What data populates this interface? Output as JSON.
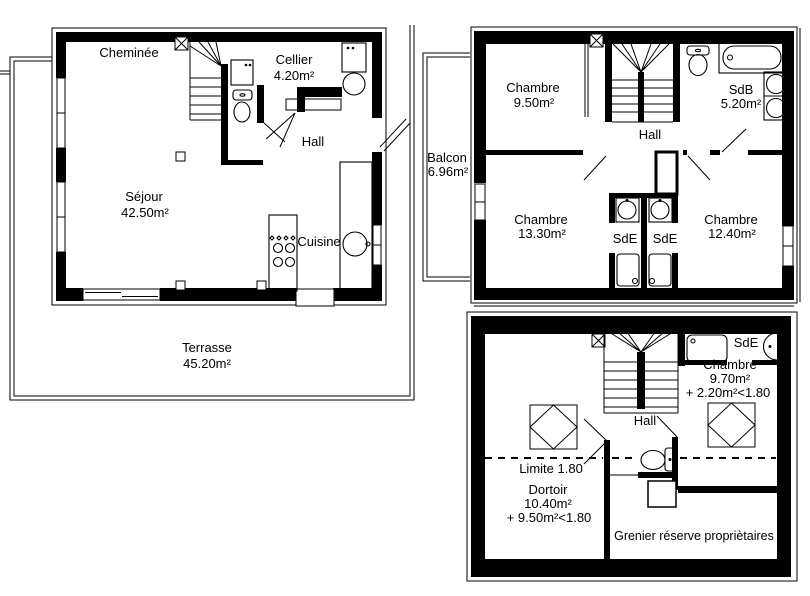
{
  "canvas": {
    "width": 810,
    "height": 596,
    "background": "#ffffff",
    "ink": "#000000"
  },
  "ground_floor": {
    "cheminee": "Cheminée",
    "cellier": "Cellier",
    "cellier_area": "4.20m²",
    "hall": "Hall",
    "sejour": "Séjour",
    "sejour_area": "42.50m²",
    "cuisine": "Cuisine",
    "terrasse": "Terrasse",
    "terrasse_area": "45.20m²"
  },
  "first_floor": {
    "chambre_nw": "Chambre",
    "chambre_nw_area": "9.50m²",
    "sdb": "SdB",
    "sdb_area": "5.20m²",
    "hall": "Hall",
    "balcon": "Balcon",
    "balcon_area": "6.96m²",
    "chambre_sw": "Chambre",
    "chambre_sw_area": "13.30m²",
    "sde_left": "SdE",
    "sde_right": "SdE",
    "chambre_se": "Chambre",
    "chambre_se_area": "12.40m²"
  },
  "attic": {
    "sde": "SdE",
    "chambre": "Chambre",
    "chambre_area": "9.70m²",
    "chambre_extra": "+ 2.20m²<1.80",
    "hall": "Hall",
    "limite": "Limite 1.80",
    "dortoir": "Dortoir",
    "dortoir_area": "10.40m²",
    "dortoir_extra": "+ 9.50m²<1.80",
    "grenier": "Grenier réserve propriètaires"
  }
}
